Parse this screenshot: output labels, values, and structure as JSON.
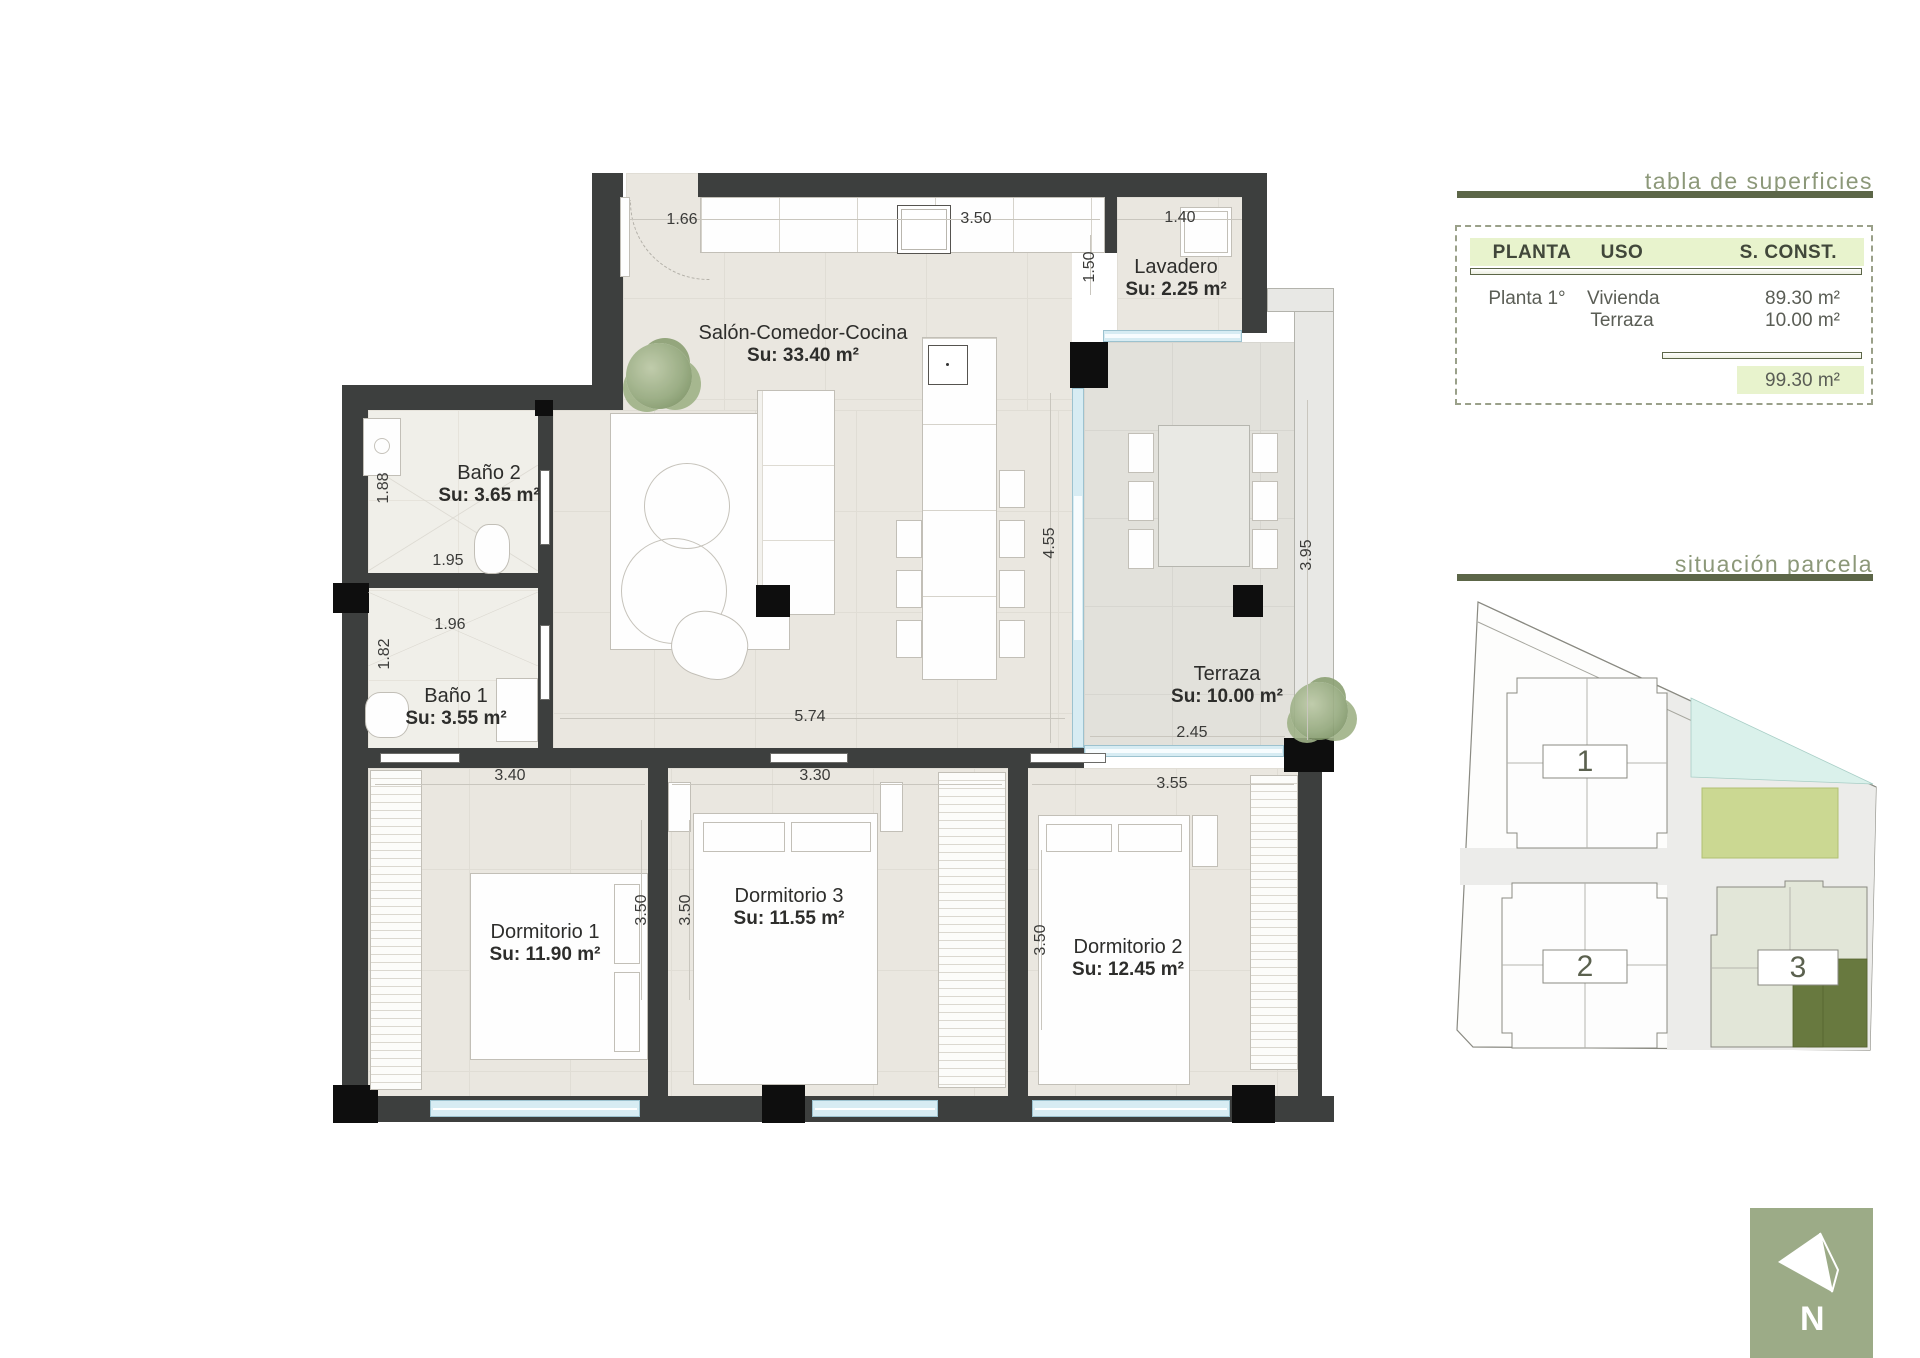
{
  "plan": {
    "rooms": {
      "salon": {
        "name": "Salón-Comedor-Cocina",
        "area": "Su: 33.40 m²"
      },
      "lavadero": {
        "name": "Lavadero",
        "area": "Su: 2.25 m²"
      },
      "bano2": {
        "name": "Baño 2",
        "area": "Su: 3.65 m²"
      },
      "bano1": {
        "name": "Baño 1",
        "area": "Su: 3.55 m²"
      },
      "terraza": {
        "name": "Terraza",
        "area": "Su: 10.00 m²"
      },
      "dorm1": {
        "name": "Dormitorio 1",
        "area": "Su: 11.90 m²"
      },
      "dorm3": {
        "name": "Dormitorio 3",
        "area": "Su: 11.55 m²"
      },
      "dorm2": {
        "name": "Dormitorio 2",
        "area": "Su: 12.45 m²"
      }
    },
    "dims": {
      "entry": "1.66",
      "kitchen_top": "3.50",
      "lavadero_top": "1.40",
      "lavadero_side": "1.50",
      "bano2_h": "1.88",
      "bano2_w": "1.95",
      "bano1_w": "1.96",
      "bano1_h": "1.82",
      "salon_w": "5.74",
      "salon_h": "4.55",
      "terraza_w": "2.45",
      "terraza_h": "3.95",
      "dorm1_w": "3.40",
      "dorm1_h": "3.50",
      "dorm3_w": "3.30",
      "dorm3_h": "3.50",
      "dorm2_w": "3.55",
      "dorm2_h": "3.50"
    }
  },
  "surfaces_table": {
    "title": "tabla de superficies",
    "headers": {
      "planta": "PLANTA",
      "uso": "USO",
      "sconst": "S. CONST."
    },
    "rows": [
      {
        "planta": "Planta 1°",
        "uso": "Vivienda",
        "sconst": "89.30 m²"
      },
      {
        "planta": "",
        "uso": "Terraza",
        "sconst": "10.00 m²"
      }
    ],
    "total": "99.30 m²"
  },
  "site": {
    "title": "situación parcela",
    "building1": "1",
    "building2": "2",
    "building3": "3"
  },
  "compass": {
    "north": "N"
  },
  "colors": {
    "wall": "#3d3f3e",
    "accent_green": "#5c6648",
    "table_header_bg": "#e8f3cd",
    "site_highlight": "#68793f",
    "compass_bg": "#9cab87",
    "glass": "#d7ecf3"
  }
}
